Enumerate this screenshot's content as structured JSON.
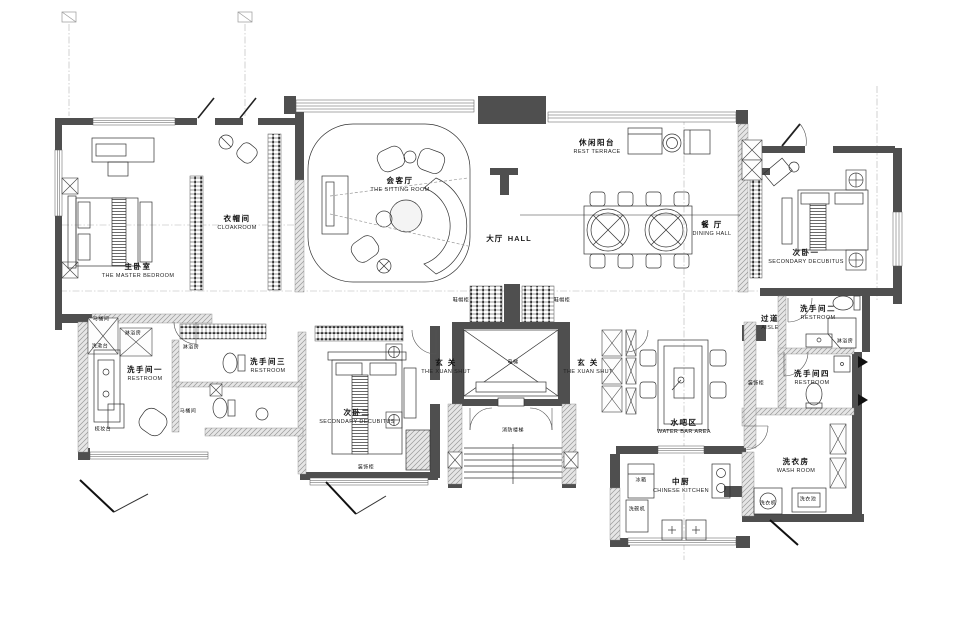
{
  "rooms": [
    {
      "id": "master-bedroom",
      "cn": "主卧室",
      "en": "THE MASTER BEDROOM"
    },
    {
      "id": "cloakroom",
      "cn": "衣帽间",
      "en": "CLOAKROOM"
    },
    {
      "id": "sitting-room",
      "cn": "会客厅",
      "en": "THE SITTING ROOM"
    },
    {
      "id": "hall",
      "cn": "大厅",
      "en": "HALL"
    },
    {
      "id": "rest-terrace",
      "cn": "休闲阳台",
      "en": "REST TERRACE"
    },
    {
      "id": "dining-hall",
      "cn": "餐 厅",
      "en": "DINING HALL"
    },
    {
      "id": "secondary-bedroom-1",
      "cn": "次卧一",
      "en": "SECONDARY DECUBITUS"
    },
    {
      "id": "restroom-2",
      "cn": "洗手间二",
      "en": "RESTROOM"
    },
    {
      "id": "aisle",
      "cn": "过道",
      "en": "AISLE"
    },
    {
      "id": "restroom-1",
      "cn": "洗手间一",
      "en": "RESTROOM"
    },
    {
      "id": "restroom-3",
      "cn": "洗手间三",
      "en": "RESTROOM"
    },
    {
      "id": "secondary-bedroom-2",
      "cn": "次卧二",
      "en": "SECONDARY DECUBITUS"
    },
    {
      "id": "entry-left",
      "cn": "玄 关",
      "en": "THE XUAN SHUT"
    },
    {
      "id": "entry-right",
      "cn": "玄 关",
      "en": "THE XUAN SHUT"
    },
    {
      "id": "water-bar",
      "cn": "水吧区",
      "en": "WATER BAR AREA"
    },
    {
      "id": "chinese-kitchen",
      "cn": "中厨",
      "en": "CHINESE KITCHEN"
    },
    {
      "id": "wash-room",
      "cn": "洗衣房",
      "en": "WASH ROOM"
    },
    {
      "id": "restroom-4",
      "cn": "洗手间四",
      "en": "RESTROOM"
    }
  ],
  "annotations": [
    {
      "id": "shoe-cabinet-left",
      "text": "鞋帽柜"
    },
    {
      "id": "shoe-cabinet-right",
      "text": "鞋帽柜"
    },
    {
      "id": "elevator",
      "text": "电梯"
    },
    {
      "id": "fire-stairs",
      "text": "消防楼梯"
    },
    {
      "id": "deco-cabinet-1",
      "text": "装饰柜"
    },
    {
      "id": "deco-cabinet-2",
      "text": "装饰柜"
    },
    {
      "id": "shower-room-r2",
      "text": "淋浴房"
    },
    {
      "id": "shower-room-r3",
      "text": "淋浴房"
    },
    {
      "id": "toilet-room-r3",
      "text": "马桶间"
    },
    {
      "id": "toilet-room-r1",
      "text": "马桶间"
    },
    {
      "id": "shower-room-r1",
      "text": "淋浴房"
    },
    {
      "id": "wash-basin-r1",
      "text": "洗漱台"
    },
    {
      "id": "dresser-r1",
      "text": "梳妆台"
    },
    {
      "id": "fridge",
      "text": "冰箱"
    },
    {
      "id": "dishwasher",
      "text": "洗碗机"
    },
    {
      "id": "washer",
      "text": "洗衣机"
    },
    {
      "id": "laundry-sink",
      "text": "洗衣池"
    }
  ]
}
